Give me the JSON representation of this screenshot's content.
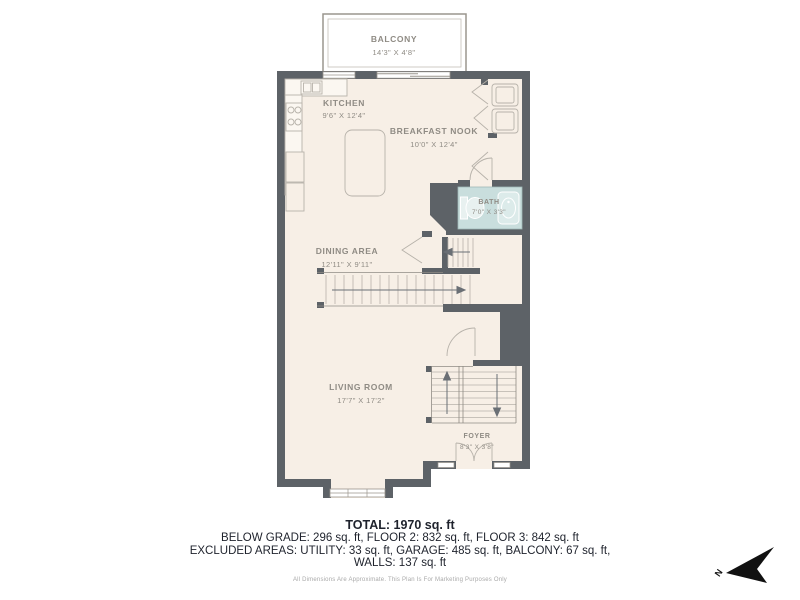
{
  "plan": {
    "balcony": {
      "name": "BALCONY",
      "dims": "14'3\" X 4'8\""
    },
    "rooms": [
      {
        "id": "kitchen",
        "name": "KITCHEN",
        "dims": "9'6\" X 12'4\""
      },
      {
        "id": "breakfast-nook",
        "name": "BREAKFAST NOOK",
        "dims": "10'0\" X 12'4\""
      },
      {
        "id": "bath",
        "name": "BATH",
        "dims": "7'0\" X 3'3\""
      },
      {
        "id": "dining-area",
        "name": "DINING AREA",
        "dims": "12'11\" X 9'11\""
      },
      {
        "id": "living-room",
        "name": "LIVING ROOM",
        "dims": "17'7\" X 17'2\""
      },
      {
        "id": "foyer",
        "name": "FOYER",
        "dims": "8'3\" X 3'8\""
      }
    ],
    "compass_label": "N"
  },
  "summary": {
    "total": "TOTAL: 1970 sq. ft",
    "line2": "BELOW GRADE: 296 sq. ft, FLOOR 2: 832 sq. ft, FLOOR 3: 842 sq. ft",
    "line3": "EXCLUDED AREAS: UTILITY: 33 sq. ft, GARAGE: 485 sq. ft, BALCONY: 67 sq. ft,",
    "line4": "WALLS: 137 sq. ft",
    "disclaimer": "All Dimensions Are Approximate. This Plan Is For Marketing Purposes Only"
  },
  "colors": {
    "wall": "#5d6267",
    "floor": "#f7efe6",
    "bath_fill": "#c9dedd",
    "fixture_line": "#b7b2aa",
    "label_text": "#8f8b84",
    "summary_text": "#1e222c",
    "compass": "#111111"
  }
}
